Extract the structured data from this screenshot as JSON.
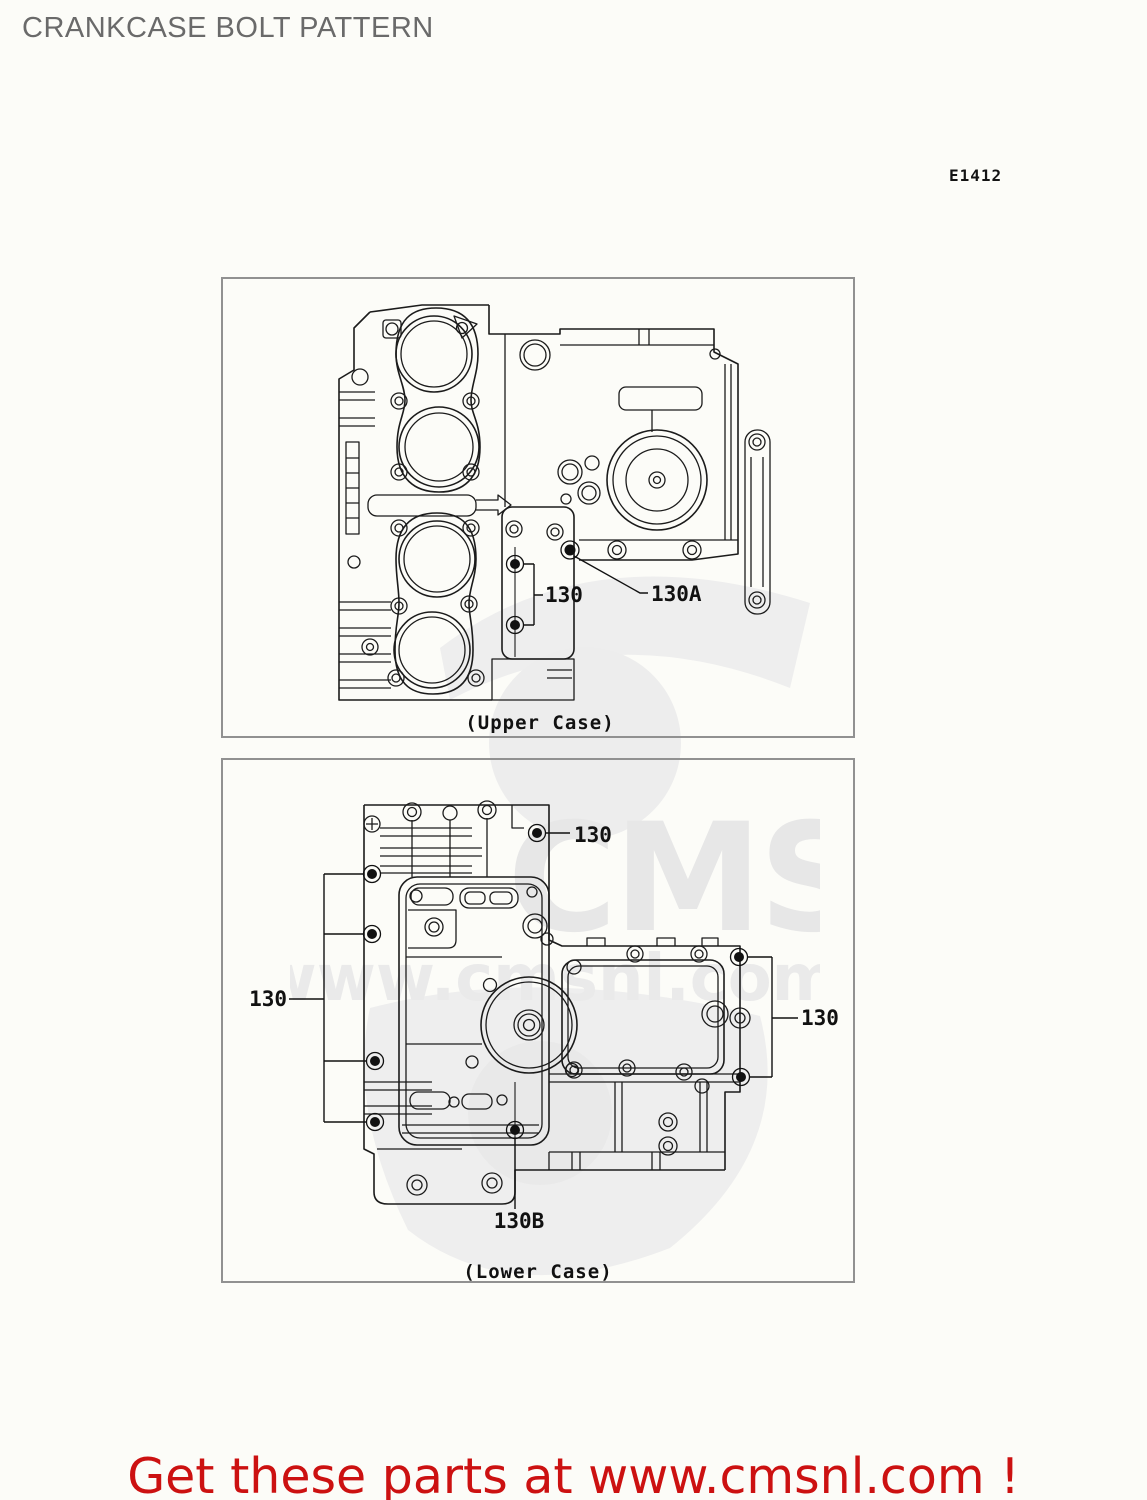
{
  "page": {
    "title": "CRANKCASE BOLT PATTERN",
    "figure_code": "E1412",
    "footer_text": "Get these parts at www.cmsnl.com !"
  },
  "watermark": {
    "brand": "CMS",
    "url": "www.cmsnl.com"
  },
  "upper_case": {
    "caption": "(Upper Case)",
    "labels": {
      "bolt_130": "130",
      "bolt_130a": "130A"
    }
  },
  "lower_case": {
    "caption": "(Lower Case)",
    "labels": {
      "top_130": "130",
      "left_130": "130",
      "right_130": "130",
      "bottom_130b": "130B"
    }
  }
}
